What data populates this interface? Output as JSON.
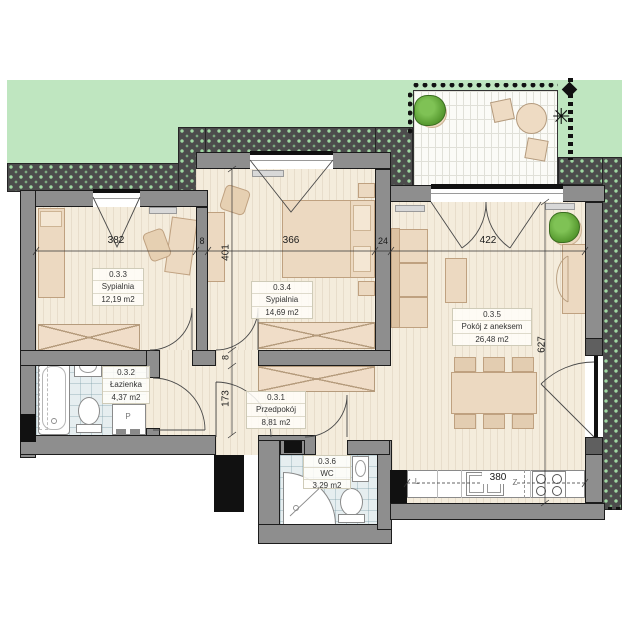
{
  "plan_title": "Apartment 0.3 floor plan",
  "rooms": {
    "r033": {
      "id": "0.3.3",
      "name": "Sypialnia",
      "area": "12,19 m2"
    },
    "r034": {
      "id": "0.3.4",
      "name": "Sypialnia",
      "area": "14,69 m2"
    },
    "r035": {
      "id": "0.3.5",
      "name": "Pokój z aneksem",
      "area": "26,48 m2"
    },
    "r032": {
      "id": "0.3.2",
      "name": "Łazienka",
      "area": "4,37 m2"
    },
    "r031": {
      "id": "0.3.1",
      "name": "Przedpokój",
      "area": "8,81 m2"
    },
    "r036": {
      "id": "0.3.6",
      "name": "WC",
      "area": "3,29 m2"
    }
  },
  "dims": {
    "bedroom1_width": "382",
    "wall_a": "8",
    "bedroom2_width": "366",
    "wall_b": "24",
    "living_width": "422",
    "bedroom2_height": "401",
    "wall_c": "8",
    "hall_height": "173",
    "living_height": "627",
    "kitchen_counter": "380"
  },
  "appliances": {
    "fridge_label": "L",
    "sink_label": "Z",
    "washer_label": "P"
  },
  "colors": {
    "lawn": "#bfe6c0",
    "hedge": "#4c4c4c",
    "wall": "#8e8e8e",
    "wood_floor": "#f4ecdc",
    "tile_floor": "#e6eef0",
    "furniture": "#ecd9c1",
    "terrace": "#fbfbf7",
    "outline": "#111111"
  }
}
